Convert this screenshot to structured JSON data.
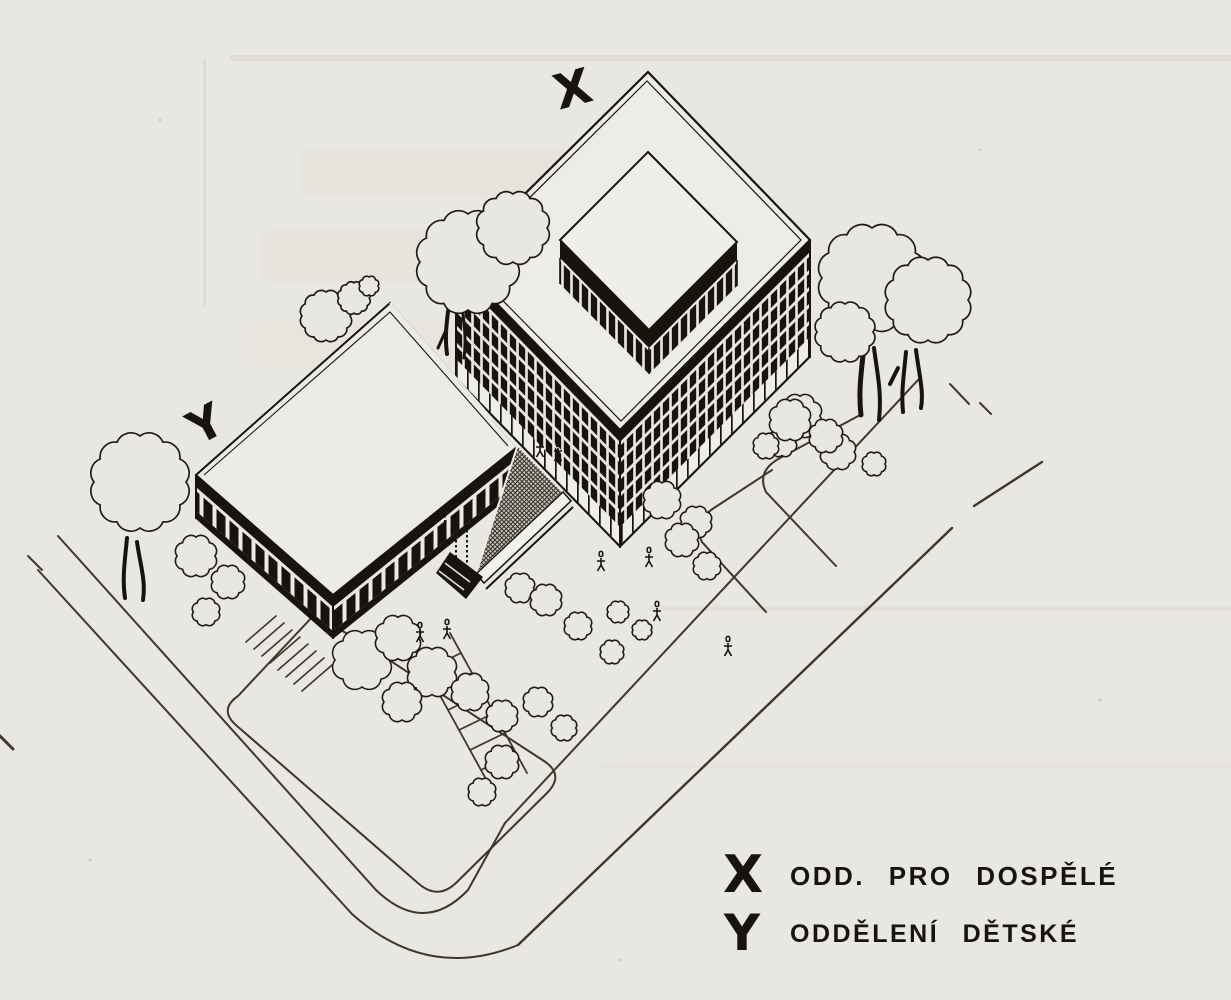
{
  "drawing": {
    "kind": "scanned axonometric site drawing of a library",
    "markers": {
      "adults_symbol": "X",
      "children_symbol": "Y"
    },
    "legend": {
      "items": [
        {
          "symbol": "X",
          "label": "ODD. PRO DOSPĚLÉ"
        },
        {
          "symbol": "Y",
          "label": "ODDĚLENÍ DĚTSKÉ"
        }
      ]
    },
    "colors": {
      "paper": "#e9e7e1",
      "ink": "#17140e",
      "line_work": "#3e382b",
      "terrace_hatch_base": "#c9c5b8"
    }
  }
}
